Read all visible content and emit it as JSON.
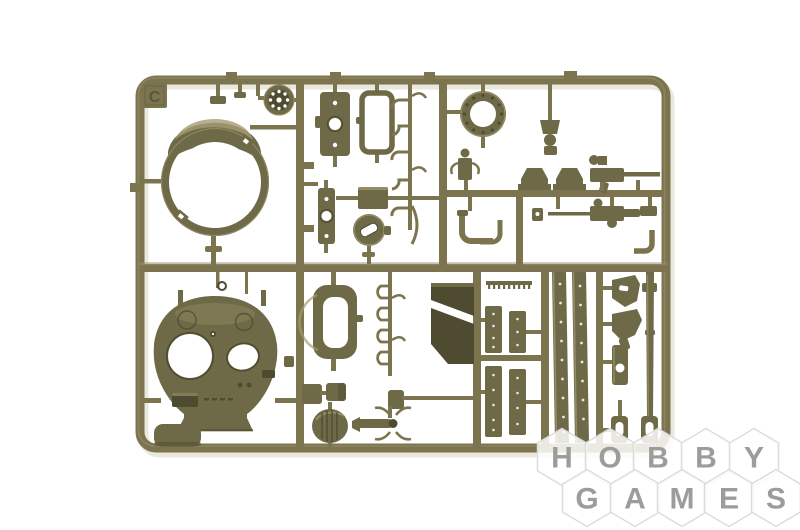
{
  "image_type": "product-photo",
  "subject": "olive-drab injection-molded plastic model kit sprue with tank turret parts on white background",
  "sprue": {
    "letter": "C",
    "color_name": "olive drab",
    "parts": [
      "turret-shell-ring",
      "road-wheel",
      "hatch-plate-with-holes",
      "rectangular-frame",
      "turret-ring-flange",
      "small-plate-with-holes",
      "round-hatch-with-slot",
      "grab-handles",
      "periscope-guards",
      "machine-gun-50cal",
      "machine-gun-second",
      "hanging-periscope",
      "elbow-pipes",
      "turret-roof-with-openings",
      "hatch-cover-frame",
      "wedge-plates",
      "riveted-plates",
      "fender-rails",
      "angled-brackets",
      "bar-with-hole",
      "gun-barrel",
      "tow-shackles",
      "ribbed-oval-part",
      "spade-grip-part",
      "small-boxes",
      "corner-plate"
    ]
  },
  "watermark": {
    "brand": "HOBBY GAMES",
    "row1": [
      "H",
      "O",
      "B",
      "B",
      "Y"
    ],
    "row2": [
      "G",
      "A",
      "M",
      "E",
      "S"
    ]
  },
  "colors": {
    "bg": "#ffffff",
    "shadow": "#e9e7de",
    "frame": "#7b744e",
    "frameLight": "#9b9270",
    "frameDark": "#575238",
    "part": "#6e6946",
    "partLight": "#a59c74",
    "partDark": "#4f4b30",
    "wmHexFill": "rgba(255,255,255,0.84)",
    "wmHexStroke": "#dcdcdc",
    "wmLetter": "#9c9c9c"
  }
}
